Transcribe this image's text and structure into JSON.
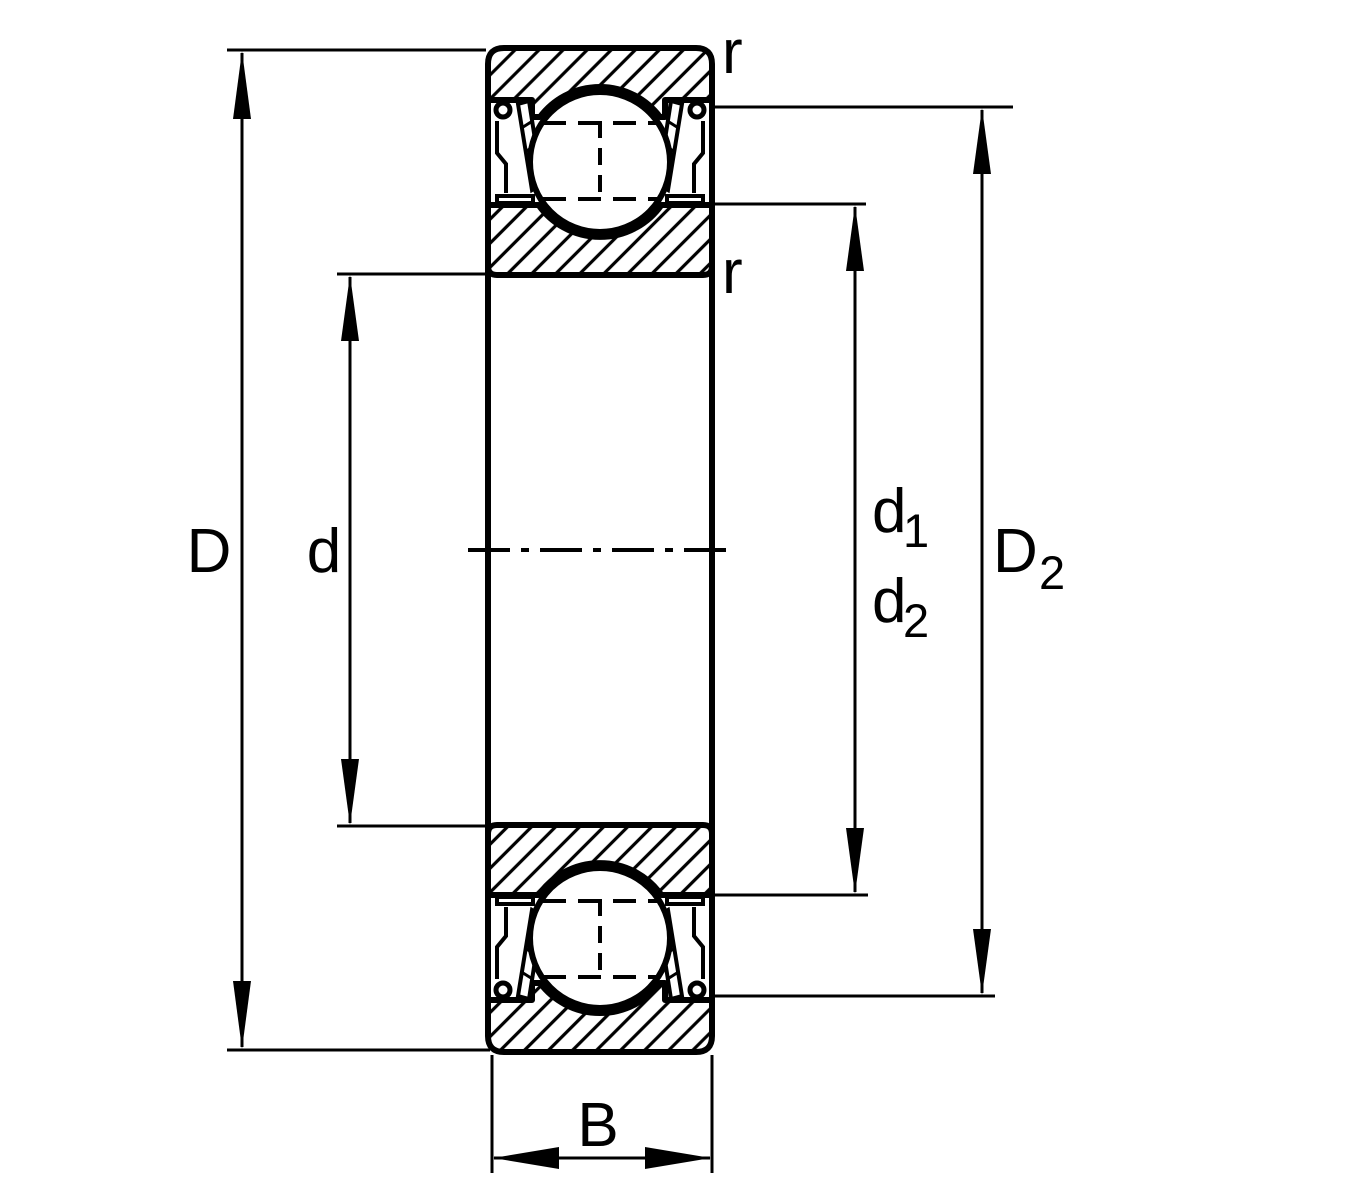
{
  "diagram": {
    "title": "sealed-deep-groove-ball-bearing-cross-section",
    "colors": {
      "line": "#000000",
      "background": "#ffffff"
    },
    "dimensions": {
      "outer_diameter": "D",
      "bore_diameter": "d",
      "d1_base": "d",
      "d1_sub": "1",
      "d2_base": "d",
      "d2_sub": "2",
      "D2_base": "D",
      "D2_sub": "2",
      "width": "B",
      "r_top": "r",
      "r_bottom": "r"
    }
  }
}
